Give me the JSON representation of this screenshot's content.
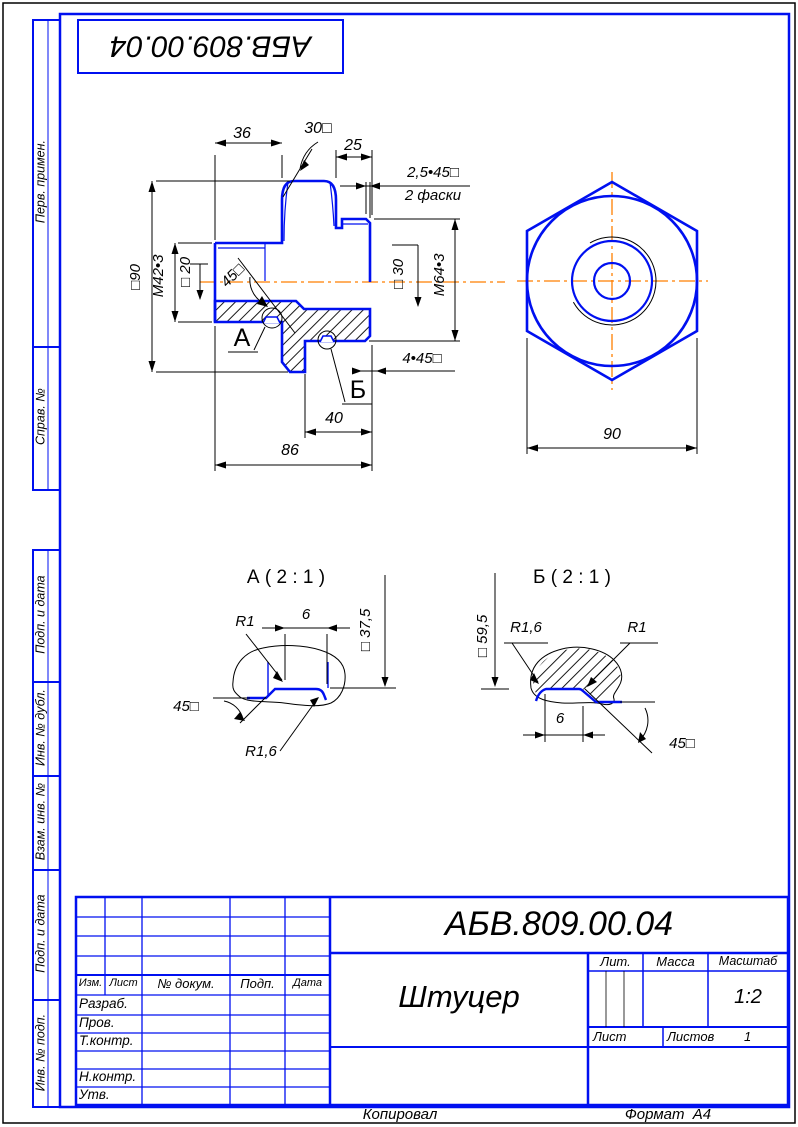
{
  "stamp": {
    "doc_number": "АБВ.809.00.04"
  },
  "sidebar": {
    "top": [
      "Перв. примен.",
      "Справ. №"
    ],
    "bottom": [
      "Подп. и дата",
      "Инв. № дубл.",
      "Взам. инв. №",
      "Подп. и дата",
      "Инв. № подп."
    ]
  },
  "views": {
    "main": {
      "dims": {
        "len36": "36",
        "ang30": "30□",
        "len25": "25",
        "chamfer25": "2,5•45□",
        "chamfer_note": "2 фаски",
        "dia90": "□90",
        "thread_m42": "М42•3",
        "dia20": "□ 20",
        "ang45": "45□",
        "dia30": "□ 30",
        "thread_m64": "М64•3",
        "chamfer445": "4•45□",
        "len40": "40",
        "len86": "86",
        "label_a": "А",
        "label_b": "Б"
      }
    },
    "end": {
      "width90": "90"
    },
    "detail_a": {
      "title": "А ( 2 : 1 )",
      "r1": "R1",
      "w6": "6",
      "dia375": "□ 37,5",
      "ang45": "45□",
      "r16": "R1,6"
    },
    "detail_b": {
      "title": "Б ( 2 : 1 )",
      "dia595": "□ 59,5",
      "r16": "R1,6",
      "r1": "R1",
      "w6": "6",
      "ang45": "45□"
    }
  },
  "title_block": {
    "doc_number": "АБВ.809.00.04",
    "part_name": "Штуцер",
    "header_cols": [
      "Изм.",
      "Лист",
      "№ докум.",
      "Подп.",
      "Дата"
    ],
    "row_labels": [
      "Разраб.",
      "Пров.",
      "Т.контр.",
      "Н.контр.",
      "Утв."
    ],
    "lit_label": "Лит.",
    "mass_label": "Масса",
    "scale_label": "Масштаб",
    "scale_value": "1:2",
    "sheet_label": "Лист",
    "sheets_label": "Листов",
    "sheets_value": "1"
  },
  "footer": {
    "copied": "Копировал",
    "format": "Формат  А4"
  },
  "colors": {
    "line_blue": "#0010f0",
    "centerline_orange": "#ff7f00",
    "text_black": "#000000"
  }
}
